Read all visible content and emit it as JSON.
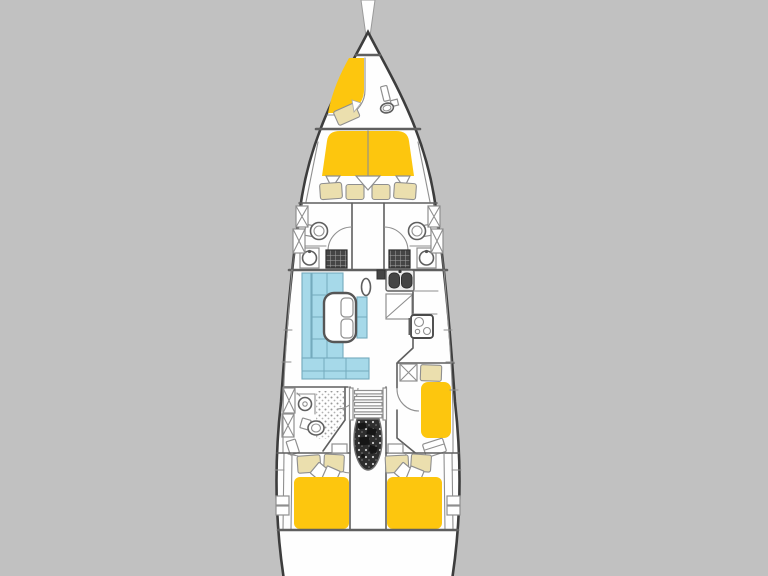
{
  "page": {
    "title": "Sailing yacht interior layout floor plan, top view, bow up, on plain gray backdrop"
  },
  "colors": {
    "background": "#c1c1c1",
    "hull_fill": "#fefefe",
    "hull_stroke": "#3d3d3d",
    "wall": "#5f5f5f",
    "wall_light": "#8f8f8f",
    "bed": "#fdc60e",
    "cushion": "#ebdfae",
    "sofa": "#a6d9e9",
    "sofa_line": "#74aabd",
    "dark_fixture": "#454545",
    "engine": "#2e2e2e",
    "stipple": "#999999"
  },
  "boat": {
    "orientation": "bow-up",
    "sections": [
      {
        "id": "bowsprit",
        "fixtures": []
      },
      {
        "id": "anchor-locker",
        "fixtures": []
      },
      {
        "id": "bow-crew-cabin",
        "fixtures": [
          "single-berth",
          "pillow",
          "door",
          "marine-toilet"
        ]
      },
      {
        "id": "owner-cabin",
        "fixtures": [
          "v-double-berth",
          "center-divider",
          "sheet-folds",
          "seat-cushion-1",
          "seat-cushion-2",
          "seat-cushion-3",
          "seat-cushion-4"
        ]
      },
      {
        "id": "ensuite-head-port",
        "fixtures": [
          "toilet",
          "shower-grate",
          "washbasin",
          "wardrobe",
          "wardrobe",
          "door"
        ]
      },
      {
        "id": "ensuite-head-starboard",
        "fixtures": [
          "toilet",
          "shower-grate",
          "washbasin",
          "wardrobe",
          "wardrobe",
          "door"
        ]
      },
      {
        "id": "salon",
        "fixtures": [
          "l-shaped-sofa",
          "folding-table",
          "stools",
          "mast-post"
        ]
      },
      {
        "id": "galley",
        "fixtures": [
          "double-sink",
          "locker",
          "cabinet",
          "stove",
          "counter"
        ]
      },
      {
        "id": "day-head-port",
        "fixtures": [
          "washbasin",
          "shower-floor",
          "toilet",
          "wardrobe",
          "wardrobe",
          "corner-stand",
          "door"
        ]
      },
      {
        "id": "companionway",
        "fixtures": [
          "stairs",
          "engine-compartment"
        ]
      },
      {
        "id": "single-cabin-starboard",
        "fixtures": [
          "wardrobe",
          "pillow",
          "single-berth",
          "vanity",
          "door"
        ]
      },
      {
        "id": "aft-cabin-port",
        "fixtures": [
          "double-berth",
          "pillow",
          "pillow",
          "cushion",
          "cushion",
          "nightstand",
          "door",
          "hull-shelves"
        ]
      },
      {
        "id": "aft-cabin-starboard",
        "fixtures": [
          "double-berth",
          "pillow",
          "pillow",
          "cushion",
          "cushion",
          "nightstand",
          "door",
          "hull-shelves"
        ]
      },
      {
        "id": "stern-lazarette",
        "fixtures": []
      }
    ]
  }
}
